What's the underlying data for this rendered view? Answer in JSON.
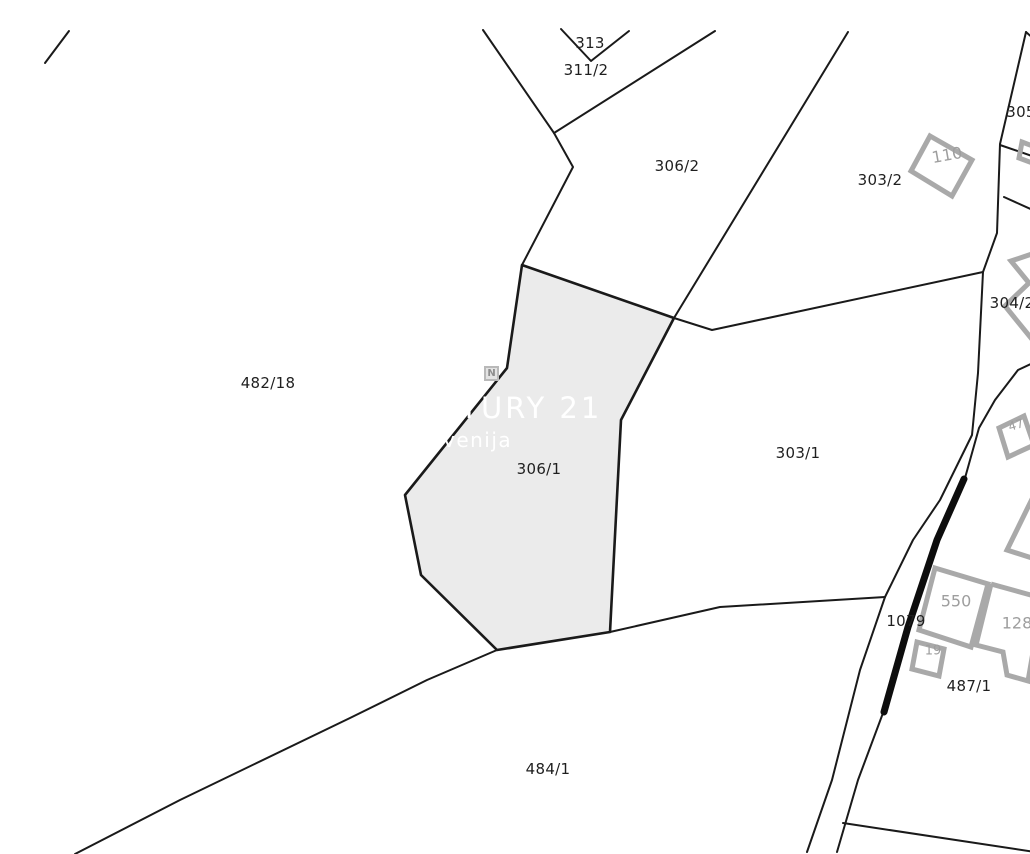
{
  "map": {
    "type": "cadastral-parcel-map",
    "highlighted_parcel": "306/1"
  },
  "watermark": {
    "brand": "CENTURY 21",
    "region": "Slovenija",
    "logo_letter": "N"
  },
  "parcels": {
    "p313": "313",
    "p311_2": "311/2",
    "p306_2": "306/2",
    "p303_2": "303/2",
    "p305": "305",
    "p304_2": "304/2",
    "p482_18": "482/18",
    "p306_1": "306/1",
    "p303_1": "303/1",
    "p1079": "1079",
    "p487_1": "487/1",
    "p484_1": "484/1"
  },
  "buildings": {
    "b110": "110",
    "b550": "550",
    "b128": "128",
    "b19": "19",
    "b47": "47"
  },
  "colors": {
    "background": "#ffffff",
    "parcel_line": "#1a1a1a",
    "highlight_fill": "#ebebeb",
    "building_outline": "#a9a9a9",
    "building_label": "#9e9e9e",
    "watermark_text": "#ffffff"
  }
}
